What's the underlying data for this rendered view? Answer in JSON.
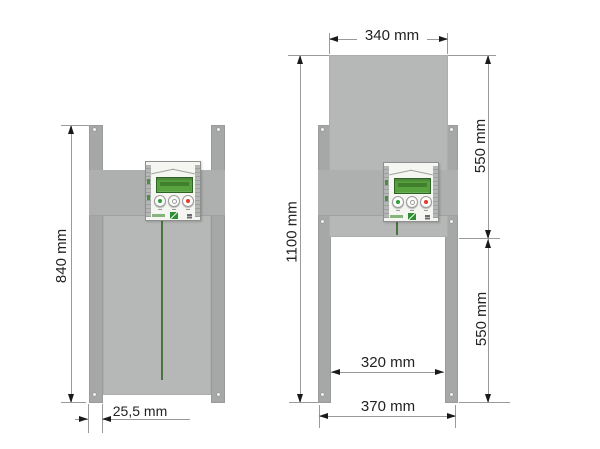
{
  "diagram": {
    "left_view": {
      "total_height": "840 mm",
      "rail_width": "25,5 mm"
    },
    "right_view": {
      "door_width": "340 mm",
      "total_height": "1100 mm",
      "upper_section_height": "550 mm",
      "lower_section_height": "550 mm",
      "inner_width": "320 mm",
      "outer_width": "370 mm"
    },
    "colors": {
      "door_panel": "#b6b8b7",
      "mounting_plate": "#aeb0af",
      "guide_rail": "#a5a8a7",
      "lcd_green": "#57a33e",
      "button_green": "#2f9e3a",
      "button_red": "#e23a2e",
      "cord_green": "#4a7342",
      "dimension_line": "#9a9a9a",
      "arrow_black": "#1a1a1a",
      "dimension_text": "#222222"
    }
  }
}
